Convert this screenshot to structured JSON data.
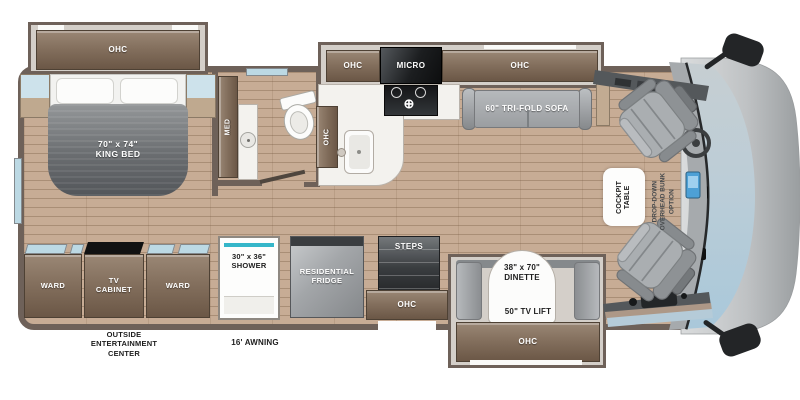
{
  "bedroom": {
    "ohc": "OHC",
    "bed_size": "70\" x 74\"",
    "bed_type": "KING BED",
    "med": "MED"
  },
  "storage": {
    "ward_left": "WARD",
    "tv_cabinet_1": "TV",
    "tv_cabinet_2": "CABINET",
    "ward_right": "WARD"
  },
  "bathroom": {
    "shower_size": "30\" x 36\"",
    "shower": "SHOWER"
  },
  "kitchen": {
    "ohc_left": "OHC",
    "micro": "MICRO",
    "ohc_right": "OHC",
    "ohc_counter": "OHC",
    "fridge_1": "RESIDENTIAL",
    "fridge_2": "FRIDGE"
  },
  "living": {
    "sofa": "60\" TRI-FOLD SOFA",
    "dinette_size": "38\" x 70\"",
    "dinette": "DINETTE",
    "tv_lift": "50\" TV LIFT",
    "dinette_ohc": "OHC"
  },
  "entry": {
    "steps": "STEPS",
    "ohc": "OHC"
  },
  "cockpit": {
    "table_1": "COCKPIT",
    "table_2": "TABLE",
    "bunk_1": "DROP-DOWN",
    "bunk_2": "OVERHEAD BUNK",
    "bunk_3": "OPTION"
  },
  "exterior": {
    "oec_1": "OUTSIDE",
    "oec_2": "ENTERTAINMENT",
    "oec_3": "CENTER",
    "awning": "16' AWNING"
  },
  "colors": {
    "wall": "#6e6159",
    "floor": "#c7ac95",
    "cabinet": "#84705e",
    "shower_accent": "#35b6c9",
    "windshield": "#b5cbd8",
    "seat_gray": "#aaaeb1",
    "awning_gray": "#b7babc"
  }
}
